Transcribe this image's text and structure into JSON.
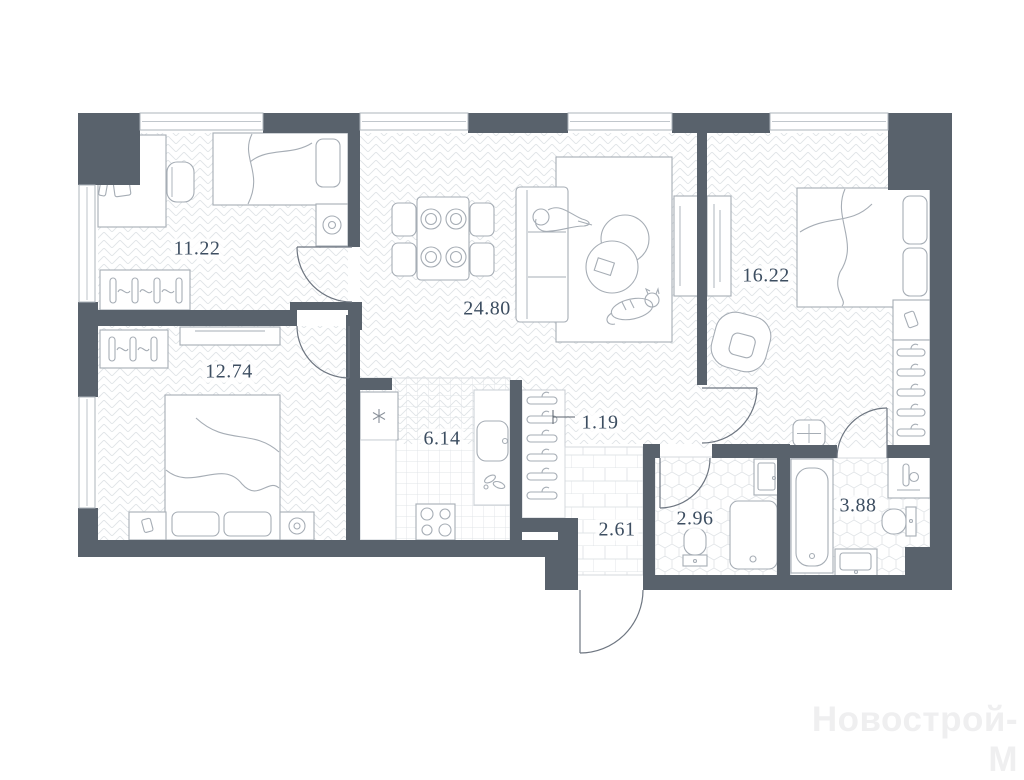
{
  "plan": {
    "watermark": "Новострой-М",
    "rooms": {
      "bedroom1": {
        "name": "bedroom-top-left",
        "label": "11.22"
      },
      "bedroom2": {
        "name": "bedroom-bottom-left",
        "label": "12.74"
      },
      "living": {
        "name": "living-room",
        "label": "24.80"
      },
      "bedroom3": {
        "name": "bedroom-right",
        "label": "16.22"
      },
      "kitchen": {
        "name": "kitchen",
        "label": "6.14"
      },
      "closet": {
        "name": "wardrobe-closet",
        "label": "1.19"
      },
      "hall": {
        "name": "entrance-hall",
        "label": "2.61"
      },
      "wc": {
        "name": "wc-shower-room",
        "label": "2.96"
      },
      "bathroom": {
        "name": "bathroom",
        "label": "3.88"
      }
    },
    "colors": {
      "wall": "#59626c",
      "label": "#3d4e61",
      "furniture": "#a6adb5",
      "pattern": "#e0e4e7",
      "watermark": "#efeff0"
    }
  }
}
